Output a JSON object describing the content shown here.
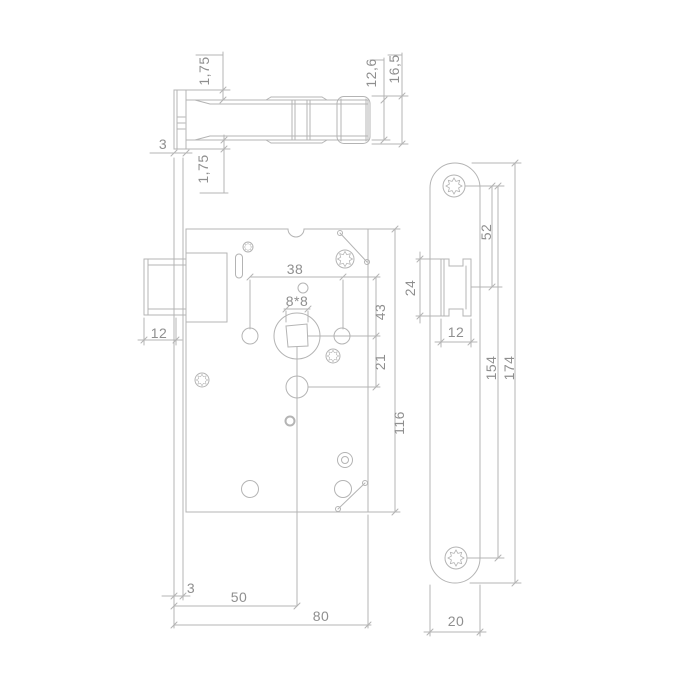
{
  "drawing": {
    "type": "technical-drawing",
    "subject": "mortise door lock with faceplate",
    "background": "#ffffff",
    "line_color": "#b4b4b4",
    "text_color": "#8f8f8f"
  },
  "dimensions": {
    "top_view": {
      "faceplate_lip_top": "1,75",
      "case_depth": "12,6",
      "overall_depth": "16,5",
      "faceplate_thickness": "3",
      "faceplate_lip_bottom": "1,75"
    },
    "front_view": {
      "latch_protrusion": "12",
      "follower_hole_spacing": "38",
      "spindle_square": "8*8",
      "follower_offset": "43",
      "cylinder_offset": "21",
      "case_height": "116",
      "faceplate_thickness": "3",
      "backset": "50",
      "case_depth": "80"
    },
    "faceplate_view": {
      "latch_height": "24",
      "screw_to_latch": "52",
      "latch_width": "12",
      "screw_hole_spacing": "154",
      "faceplate_length": "174",
      "faceplate_width": "20"
    }
  }
}
